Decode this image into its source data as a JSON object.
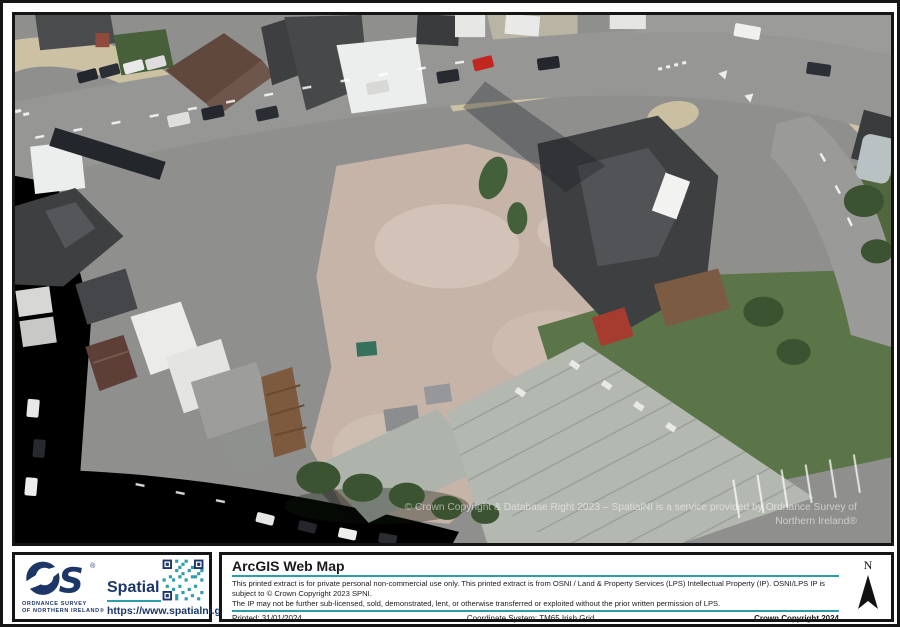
{
  "map": {
    "watermark_line1": "© Crown Copyright & Database Right 2023 – SpatialNI  is a service provided by Ordnance Survey of",
    "watermark_line2": "Northern Ireland®"
  },
  "footer": {
    "logo": {
      "org_line1": "ORDNANCE SURVEY",
      "org_line2": "OF NORTHERN IRELAND®",
      "brand": "Spatial NI",
      "url": "https://www.spatialni.gov.uk"
    },
    "info": {
      "title": "ArcGIS Web Map",
      "disclaimer1": "This printed extract is for private personal non-commercial use only.  This printed extract is from OSNI / Land & Property Services (LPS) Intellectual Property (IP). OSNI/LPS IP is subject to © Crown Copyright 2023 SPNI.",
      "disclaimer2": "The IP may not be further sub-licensed, sold, demonstrated, lent, or otherwise transferred or exploited without the prior written permission of LPS.",
      "printed": "Printed: 31/01/2024",
      "coordinate_system": "Coordinate System: TM65 Irish Grid",
      "copyright": "Crown Copyright 2024",
      "north_label": "N"
    },
    "colors": {
      "accent_teal": "#2d9daa",
      "brand_navy": "#1c3668"
    }
  }
}
